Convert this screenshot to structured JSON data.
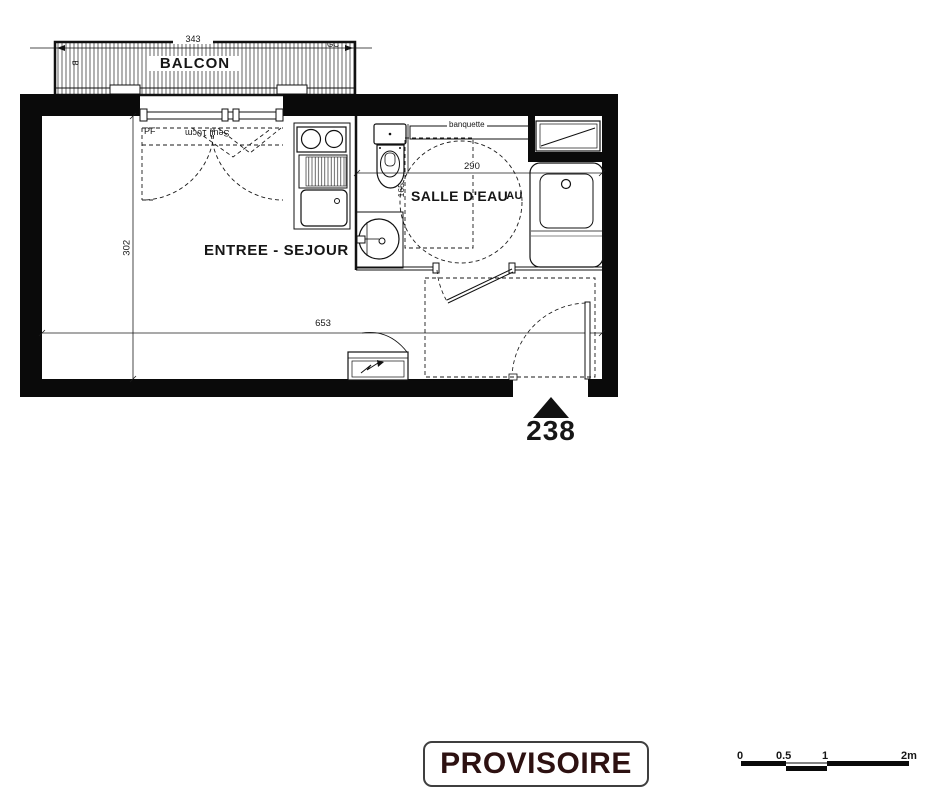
{
  "plan": {
    "balcony": {
      "label": "BALCON",
      "dim_width": "343",
      "tag_left": "B",
      "tag_right": "GC"
    },
    "living_room": {
      "label": "ENTREE - SEJOUR",
      "dim_width": "653",
      "dim_height": "302",
      "window_label": "PF",
      "threshold_label": "Seuil 10cm"
    },
    "bathroom": {
      "label": "SALLE D'EAU",
      "label_artifact": "AU",
      "bench_label": "banquette",
      "dim_width": "290",
      "dim_height": "165"
    },
    "entrance": {
      "unit_number": "238"
    }
  },
  "stamp": {
    "label": "PROVISOIRE"
  },
  "scale_bar": {
    "ticks": [
      "0",
      "0.5",
      "1",
      "2m"
    ]
  },
  "colors": {
    "line": "#1a1a1a",
    "wall": "#0a0a0a",
    "stamp_text": "#2d1111"
  }
}
